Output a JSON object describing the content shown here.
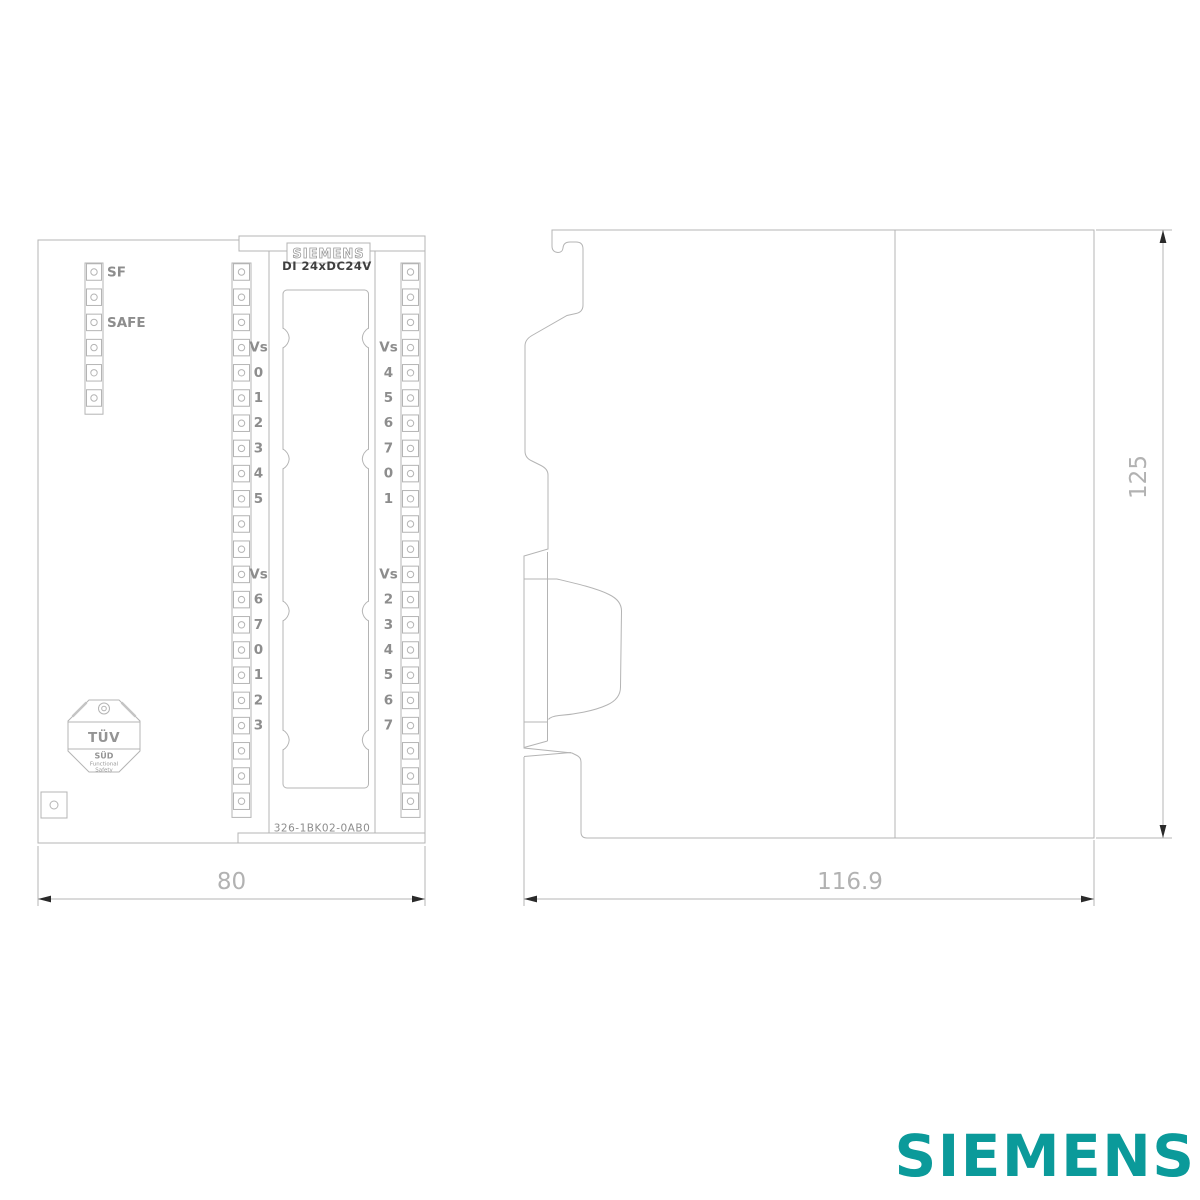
{
  "front_view": {
    "sf_label": "SF",
    "safe_label": "SAFE",
    "plate": {
      "logo": "SIEMENS",
      "model": "DI 24xDC24V"
    },
    "middle_strip": {
      "top": [
        "Vs",
        "0",
        "1",
        "2",
        "3",
        "4",
        "5"
      ],
      "bottom": [
        "Vs",
        "6",
        "7",
        "0",
        "1",
        "2",
        "3"
      ]
    },
    "right_strip": {
      "top": [
        "Vs",
        "4",
        "5",
        "6",
        "7",
        "0",
        "1"
      ],
      "bottom": [
        "Vs",
        "2",
        "3",
        "4",
        "5",
        "6",
        "7"
      ]
    },
    "tuv_badge": {
      "title": "TÜV",
      "subtitle": "SÜD",
      "line3": "Functional",
      "line4": "Safety"
    },
    "part_number": "326-1BK02-0AB0",
    "width_mm": "80"
  },
  "side_view": {
    "depth_mm": "116.9",
    "height_mm": "125"
  },
  "footer": {
    "brand": "SIEMENS"
  },
  "colors": {
    "line": "#b4b4b4",
    "label": "#8d8d8d",
    "model_text": "#3f3f3f",
    "dimension_text": "#b2b2b2",
    "arrow": "#2a2a2a",
    "brand": "#0b9a9a"
  }
}
